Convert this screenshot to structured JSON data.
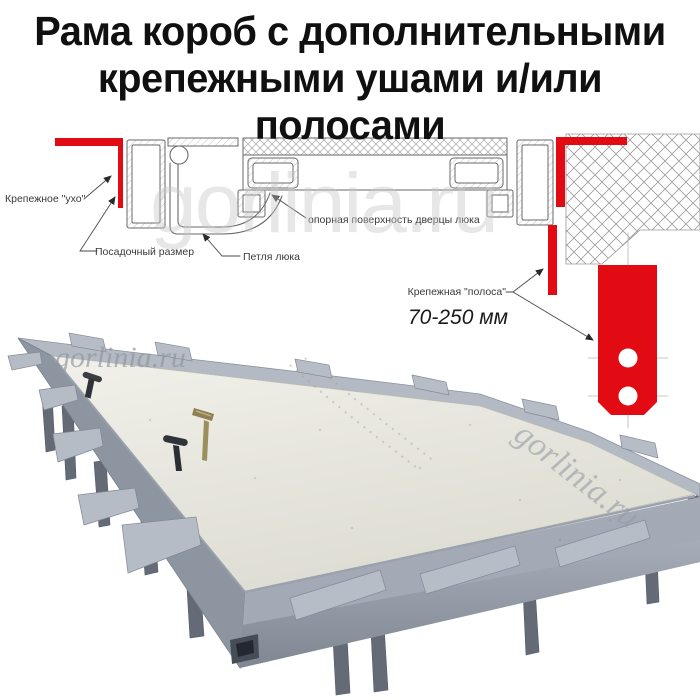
{
  "title": {
    "line1": "Рама короб с дополнительными",
    "line2": "крепежными ушами и/или полосами"
  },
  "diagram": {
    "label_ear": "Крепежное \"ухо\"",
    "label_seat": "Посадочный размер",
    "label_hinge": "Петля люка",
    "label_support": "опорная поверхность дверцы люка",
    "label_strip": "Крепежная \"полоса\"",
    "label_strip_range": "70-250 мм"
  },
  "watermarks": {
    "main": "gorlinia.ru",
    "panel": "gorlinia.ru",
    "diagonal": "gorlinia.ru"
  },
  "colors": {
    "red": "#e30b13",
    "line": "#6a6a6a",
    "frame": "#aab1bc",
    "panel": "#ebeae2"
  }
}
